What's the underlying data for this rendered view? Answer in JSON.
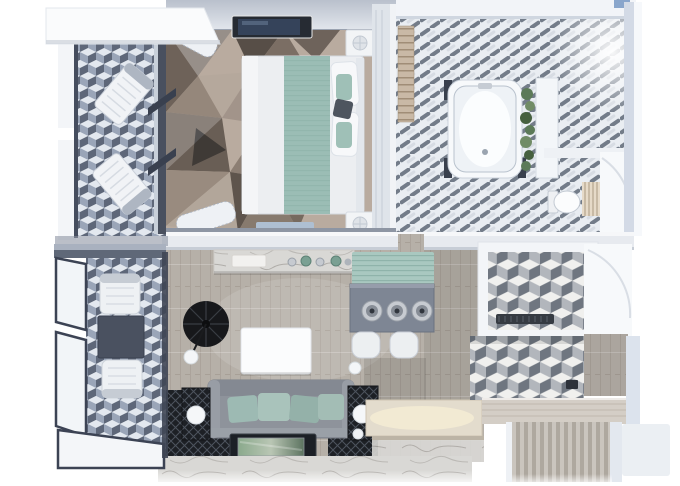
{
  "meta": {
    "type": "3d-floor-plan-render",
    "view": "top-down",
    "width_px": 680,
    "height_px": 486
  },
  "palette": {
    "teal": "#93b7af",
    "teal_light": "#a9c8c0",
    "wood": "#b6b0a8",
    "carpet_base": "#b9ab9f",
    "sofa": "#8e939b",
    "lamp_black": "#17181b",
    "wall": "#eef1f5",
    "wall_shade": "#c7cdd6",
    "glass_frame": "#3c4354",
    "cube_top": "#e3e8ef",
    "cube_left": "#9aa5b8",
    "cube_right": "#5e6779",
    "cube_gray_top": "#f0f0ee",
    "cube_gray_left": "#b2b6bc",
    "cube_gray_right": "#6f7680",
    "tile_dash": "#5e6876",
    "tile_base": "#e9edf2",
    "marble": "#d9d8d5",
    "marble_vein": "#8e8a84",
    "counter_warm": "#ecdfc4",
    "bar_table": "#7e8694",
    "plant_green": "#5c7a58",
    "rug_dark": "#1d2025"
  },
  "scene": {
    "rooms": [
      {
        "name": "balcony-upper",
        "floor": "blue-cube-tiles",
        "items": [
          "awning-roof",
          "lounge-chair",
          "lounge-chair",
          "glass-wall"
        ]
      },
      {
        "name": "bedroom",
        "floor": "geometric-triangle-carpet",
        "items": [
          "wall-tv",
          "double-bed",
          "teal-runner",
          "pillows",
          "nightstand",
          "nightstand",
          "table-lamp",
          "table-lamp",
          "bench",
          "curtains",
          "wardrobe-partition"
        ]
      },
      {
        "name": "bathroom",
        "floor": "diagonal-dash-tiles",
        "items": [
          "wood-shelf",
          "bathtub",
          "plant-strip",
          "white-panel",
          "toilet",
          "towel-ladder",
          "door-swing-arc"
        ]
      },
      {
        "name": "living-room",
        "floor": "wood-planks",
        "items": [
          "marble-sideboard",
          "decor-bottles",
          "teal-area-rug",
          "bar-table",
          "pendant-light",
          "pendant-light",
          "pendant-light",
          "bar-stool",
          "bar-stool",
          "arc-floor-lamp",
          "sphere-lamp",
          "coffee-table",
          "sofa",
          "teal-cushions",
          "wire-side-table",
          "wire-side-table",
          "sphere-lamp",
          "dark-mesh-rug",
          "tv-console",
          "marble-media-wall"
        ]
      },
      {
        "name": "kitchen",
        "floor": "wood-planks",
        "items": [
          "marble-island-counter",
          "under-counter-light"
        ]
      },
      {
        "name": "shower-room",
        "floor": "gray-cube-tiles",
        "items": [
          "linear-drain",
          "glass-door-swing"
        ]
      },
      {
        "name": "entry-hall",
        "floor": "gray-cube-tiles",
        "items": [
          "wood-step",
          "wood-closet",
          "wall-switch",
          "corridor-striped-floor"
        ]
      },
      {
        "name": "balcony-lower",
        "floor": "blue-cube-tiles",
        "items": [
          "glass-railing",
          "armchair",
          "armchair",
          "square-side-table"
        ]
      }
    ]
  }
}
